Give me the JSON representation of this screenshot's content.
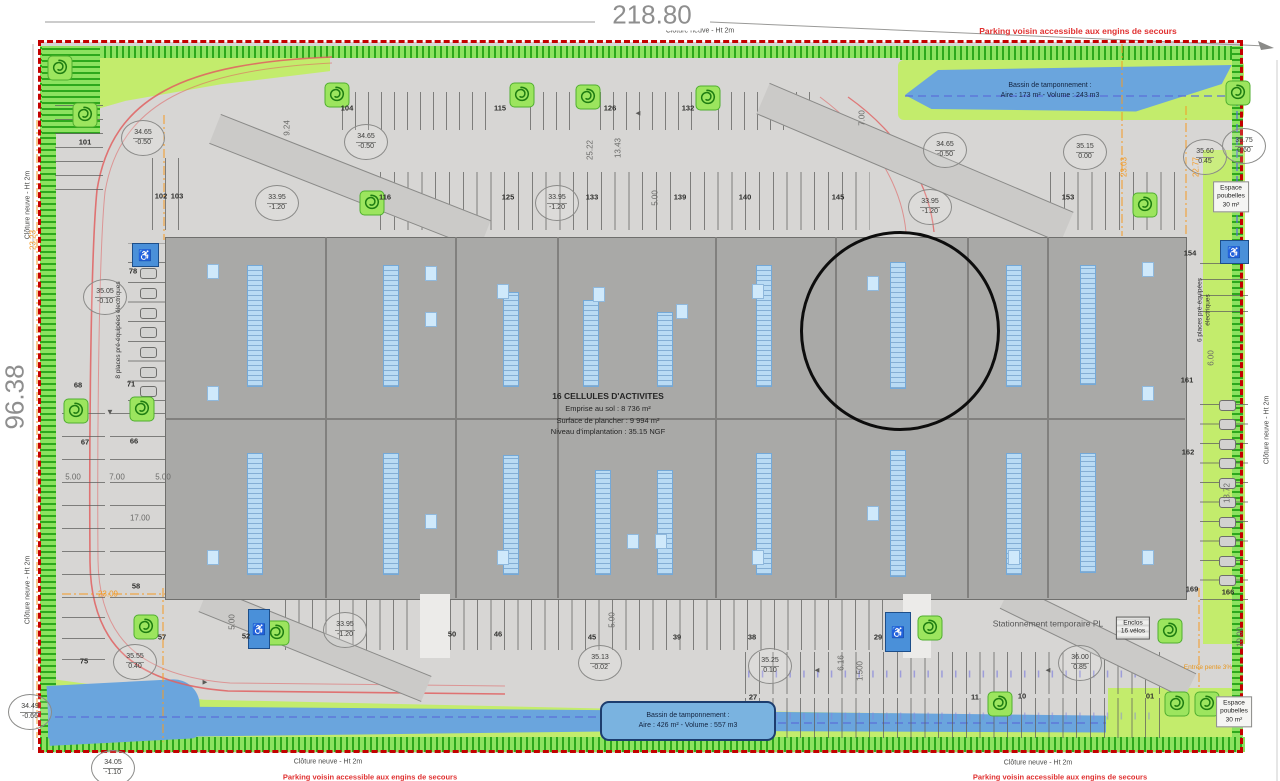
{
  "dims_main": {
    "top": "218.80",
    "left": "96.38"
  },
  "notes": {
    "parking_voisin": "Parking voisin accessible aux engins de secours",
    "cloture": "Clôture neuve - Ht 2m"
  },
  "building": {
    "l1": "16 CELLULES D'ACTIVITES",
    "l2": "Emprise au sol : 8 736 m²",
    "l3": "Surface de plancher : 9 994 m²",
    "l4": "Niveau d'implantation : 35.15 NGF"
  },
  "basin_top": {
    "l1": "Bassin de tamponnement :",
    "l2": "Aire : 173 m² - Volume : 243 m3"
  },
  "basin_bottom": {
    "l1": "Bassin de tamponnement :",
    "l2": "Aire : 426 m² - Volume : 557 m3"
  },
  "colors": {
    "boundary": "#c40000",
    "hedge": "#8ce25f",
    "basin": "#6aa5dd",
    "accent_orange": "#f59a23",
    "annotation": "#0d0d0d",
    "red_note": "#e03030"
  },
  "levels": [
    [
      143,
      138,
      "34.65",
      "-0.50"
    ],
    [
      277,
      203,
      "33.95",
      "-1.20"
    ],
    [
      366,
      142,
      "34.65",
      "-0.50"
    ],
    [
      557,
      203,
      "33.95",
      "-1.20"
    ],
    [
      945,
      150,
      "34.65",
      "-0.50"
    ],
    [
      930,
      207,
      "33.95",
      "-1.20"
    ],
    [
      1085,
      152,
      "35.15",
      "0.00"
    ],
    [
      1205,
      157,
      "35.60",
      "0.45"
    ],
    [
      1244,
      146,
      "35.75",
      "0.60"
    ],
    [
      105,
      297,
      "35.05",
      "-0.10"
    ],
    [
      135,
      662,
      "35.55",
      "0.40"
    ],
    [
      345,
      630,
      "33.95",
      "-1.20"
    ],
    [
      600,
      663,
      "35.13",
      "-0.02"
    ],
    [
      770,
      666,
      "35.25",
      "0.10"
    ],
    [
      1080,
      663,
      "36.00",
      "0.85"
    ],
    [
      113,
      768,
      "34.05",
      "-1.10"
    ],
    [
      30,
      712,
      "34.49",
      "-0.66"
    ]
  ],
  "spots": [
    [
      347,
      108,
      "104"
    ],
    [
      500,
      108,
      "115"
    ],
    [
      610,
      108,
      "126"
    ],
    [
      688,
      108,
      "132"
    ],
    [
      385,
      197,
      "116"
    ],
    [
      508,
      197,
      "125"
    ],
    [
      592,
      197,
      "133"
    ],
    [
      680,
      197,
      "139"
    ],
    [
      745,
      197,
      "140"
    ],
    [
      838,
      197,
      "145"
    ],
    [
      1068,
      197,
      "153"
    ],
    [
      85,
      142,
      "101"
    ],
    [
      161,
      196,
      "102"
    ],
    [
      177,
      196,
      "103"
    ],
    [
      133,
      271,
      "78"
    ],
    [
      131,
      384,
      "71"
    ],
    [
      78,
      385,
      "68"
    ],
    [
      85,
      442,
      "67"
    ],
    [
      134,
      441,
      "66"
    ],
    [
      136,
      586,
      "58"
    ],
    [
      84,
      661,
      "75"
    ],
    [
      162,
      637,
      "57"
    ],
    [
      246,
      636,
      "52"
    ],
    [
      452,
      634,
      "50"
    ],
    [
      498,
      634,
      "46"
    ],
    [
      592,
      637,
      "45"
    ],
    [
      677,
      637,
      "39"
    ],
    [
      752,
      637,
      "38"
    ],
    [
      878,
      637,
      "29"
    ],
    [
      753,
      697,
      "27"
    ],
    [
      975,
      697,
      "11"
    ],
    [
      1022,
      696,
      "10"
    ],
    [
      1150,
      696,
      "01"
    ],
    [
      1190,
      253,
      "154"
    ],
    [
      1187,
      380,
      "161"
    ],
    [
      1188,
      452,
      "162"
    ],
    [
      1192,
      589,
      "169"
    ],
    [
      1228,
      592,
      "166"
    ]
  ],
  "dims": [
    [
      287,
      128,
      "9.24",
      -90,
      0
    ],
    [
      590,
      150,
      "25.22",
      -90,
      0
    ],
    [
      618,
      148,
      "13.43",
      -90,
      0
    ],
    [
      655,
      198,
      "5.00",
      -90,
      0
    ],
    [
      862,
      118,
      "7.00",
      -90,
      0
    ],
    [
      73,
      477,
      "5.00",
      0,
      0
    ],
    [
      117,
      477,
      "7.00",
      0,
      0
    ],
    [
      163,
      477,
      "5.00",
      0,
      0
    ],
    [
      140,
      518,
      "17.00",
      0,
      0
    ],
    [
      232,
      622,
      "5.00",
      -90,
      0
    ],
    [
      612,
      620,
      "5.00",
      -90,
      0
    ],
    [
      841,
      663,
      "6.16",
      -90,
      0
    ],
    [
      860,
      671,
      "1.500",
      -90,
      0
    ],
    [
      1240,
      637,
      "10.00",
      -90,
      0
    ],
    [
      1211,
      358,
      "6.00",
      -90,
      0
    ],
    [
      1227,
      493,
      "13.72",
      -90,
      0
    ],
    [
      33,
      240,
      "23.23",
      -90,
      1
    ],
    [
      108,
      594,
      "23.09",
      0,
      1
    ],
    [
      1124,
      167,
      "23.03",
      -90,
      1
    ],
    [
      1196,
      167,
      "22.77",
      -90,
      1
    ]
  ],
  "labels": [
    {
      "t": "Stationnement temporaire PL",
      "x": 1048,
      "y": 624,
      "r": 0,
      "s": 8.5,
      "c": "#555555",
      "box": "none",
      "name": "temporary-truck-parking-label"
    },
    {
      "t": "Enclos\n16 vélos",
      "x": 1133,
      "y": 628,
      "r": 0,
      "s": 6.5,
      "c": "#222222",
      "box": "hatch",
      "name": "bike-enclosure-label"
    },
    {
      "t": "Entrée pente 3%",
      "x": 1208,
      "y": 668,
      "r": 0,
      "s": 6.5,
      "c": "#e8971e",
      "box": "none",
      "name": "entrance-slope-label"
    },
    {
      "t": "Espace\npoubelles\n30 m²",
      "x": 1231,
      "y": 197,
      "r": 0,
      "s": 6.5,
      "c": "#222222",
      "box": "plain",
      "name": "waste-area-label"
    },
    {
      "t": "Espace\npoubelles\n30 m²",
      "x": 1234,
      "y": 712,
      "r": 0,
      "s": 6.5,
      "c": "#222222",
      "box": "plain",
      "name": "waste-area-label"
    },
    {
      "t": "8 places pré-équipées électriques",
      "x": 119,
      "y": 330,
      "r": -90,
      "s": 6.5,
      "c": "#333333",
      "box": "none",
      "name": "ev-spaces-label"
    },
    {
      "t": "6 places pré-équipées électriques",
      "x": 1205,
      "y": 310,
      "r": -90,
      "s": 6.5,
      "c": "#333333",
      "box": "none",
      "name": "ev-spaces-label"
    }
  ],
  "fence_positions": [
    [
      700,
      31,
      0
    ],
    [
      328,
      762,
      0
    ],
    [
      1038,
      763,
      0
    ],
    [
      28,
      205,
      -90
    ],
    [
      28,
      590,
      -90
    ],
    [
      1267,
      430,
      -90
    ]
  ],
  "bottom_notes": [
    [
      370,
      777
    ],
    [
      1060,
      777
    ]
  ],
  "building_grid": {
    "rect": [
      165,
      237,
      1020,
      361
    ],
    "x": [
      325,
      455,
      557,
      715,
      835,
      967,
      1047
    ],
    "mid_y": 418
  },
  "strips": [
    [
      254,
      265,
      120
    ],
    [
      390,
      265,
      120
    ],
    [
      510,
      292,
      93
    ],
    [
      590,
      300,
      85
    ],
    [
      664,
      312,
      73
    ],
    [
      763,
      265,
      120
    ],
    [
      897,
      262,
      125
    ],
    [
      1013,
      265,
      120
    ],
    [
      1087,
      265,
      118
    ],
    [
      254,
      453,
      120
    ],
    [
      390,
      453,
      120
    ],
    [
      510,
      455,
      118
    ],
    [
      602,
      470,
      103
    ],
    [
      664,
      470,
      103
    ],
    [
      763,
      453,
      120
    ],
    [
      897,
      450,
      125
    ],
    [
      1013,
      453,
      120
    ],
    [
      1087,
      453,
      118
    ]
  ],
  "squares": [
    [
      212,
      270
    ],
    [
      430,
      272
    ],
    [
      502,
      290
    ],
    [
      598,
      293
    ],
    [
      681,
      310
    ],
    [
      757,
      290
    ],
    [
      872,
      282
    ],
    [
      1147,
      268
    ],
    [
      212,
      392
    ],
    [
      430,
      318
    ],
    [
      1147,
      392
    ],
    [
      212,
      556
    ],
    [
      430,
      520
    ],
    [
      502,
      556
    ],
    [
      632,
      540
    ],
    [
      660,
      540
    ],
    [
      757,
      556
    ],
    [
      872,
      512
    ],
    [
      1013,
      556
    ],
    [
      1147,
      556
    ]
  ],
  "trees": [
    [
      337,
      95
    ],
    [
      522,
      95
    ],
    [
      588,
      97
    ],
    [
      708,
      98
    ],
    [
      372,
      203
    ],
    [
      1145,
      205
    ],
    [
      76,
      411
    ],
    [
      142,
      409
    ],
    [
      146,
      627
    ],
    [
      277,
      633
    ],
    [
      930,
      628
    ],
    [
      1170,
      631
    ],
    [
      1000,
      704
    ],
    [
      1177,
      704
    ],
    [
      1207,
      704
    ],
    [
      85,
      115
    ],
    [
      60,
      68
    ],
    [
      1238,
      93
    ]
  ],
  "handicaps": [
    [
      144,
      254,
      25,
      22
    ],
    [
      258,
      628,
      20,
      38
    ],
    [
      897,
      631,
      24,
      38
    ],
    [
      1233,
      251,
      27,
      22
    ]
  ],
  "cars": [
    {
      "x": 147,
      "y": 253,
      "n": 8,
      "p": 19.7,
      "w": 15,
      "h": 9
    },
    {
      "x": 1226,
      "y": 404,
      "n": 10,
      "p": 19.5,
      "w": 15,
      "h": 9
    }
  ],
  "combs": [
    [
      342,
      92,
      156,
      38,
      13,
      "v"
    ],
    [
      530,
      92,
      52,
      38,
      13,
      "v"
    ],
    [
      600,
      92,
      100,
      38,
      13,
      "v"
    ],
    [
      718,
      92,
      104,
      38,
      13,
      "v"
    ],
    [
      380,
      172,
      300,
      58,
      13.8,
      "v"
    ],
    [
      690,
      172,
      180,
      58,
      13.8,
      "v"
    ],
    [
      1050,
      172,
      130,
      58,
      13.8,
      "v"
    ],
    [
      152,
      158,
      38,
      72,
      13,
      "v"
    ],
    [
      285,
      600,
      132,
      50,
      13.5,
      "v"
    ],
    [
      450,
      600,
      445,
      50,
      13.5,
      "v"
    ],
    [
      745,
      652,
      418,
      42,
      13.8,
      "v"
    ],
    [
      745,
      698,
      418,
      40,
      13.8,
      "v"
    ],
    [
      128,
      243,
      40,
      158,
      19.7,
      "h"
    ],
    [
      62,
      393,
      43,
      205,
      23,
      "h"
    ],
    [
      110,
      393,
      65,
      205,
      23,
      "h"
    ],
    [
      62,
      598,
      43,
      62,
      21,
      "h"
    ],
    [
      1200,
      395,
      48,
      205,
      19.5,
      "h"
    ],
    [
      1200,
      248,
      48,
      64,
      16,
      "h"
    ],
    [
      55,
      95,
      48,
      95,
      14,
      "h"
    ]
  ],
  "ramps": [
    [
      350,
      182,
      290,
      30,
      21.5
    ],
    [
      915,
      163,
      330,
      32,
      23
    ],
    [
      1098,
      641,
      205,
      26,
      26
    ],
    [
      315,
      644,
      240,
      26,
      22
    ]
  ],
  "aisles": [
    [
      420,
      594,
      30,
      64
    ],
    [
      903,
      594,
      28,
      64
    ]
  ],
  "arrows": [
    [
      638,
      113,
      "◄"
    ],
    [
      205,
      682,
      "►"
    ],
    [
      817,
      670,
      "◄"
    ],
    [
      1048,
      670,
      "◄"
    ],
    [
      110,
      412,
      "▼"
    ]
  ]
}
